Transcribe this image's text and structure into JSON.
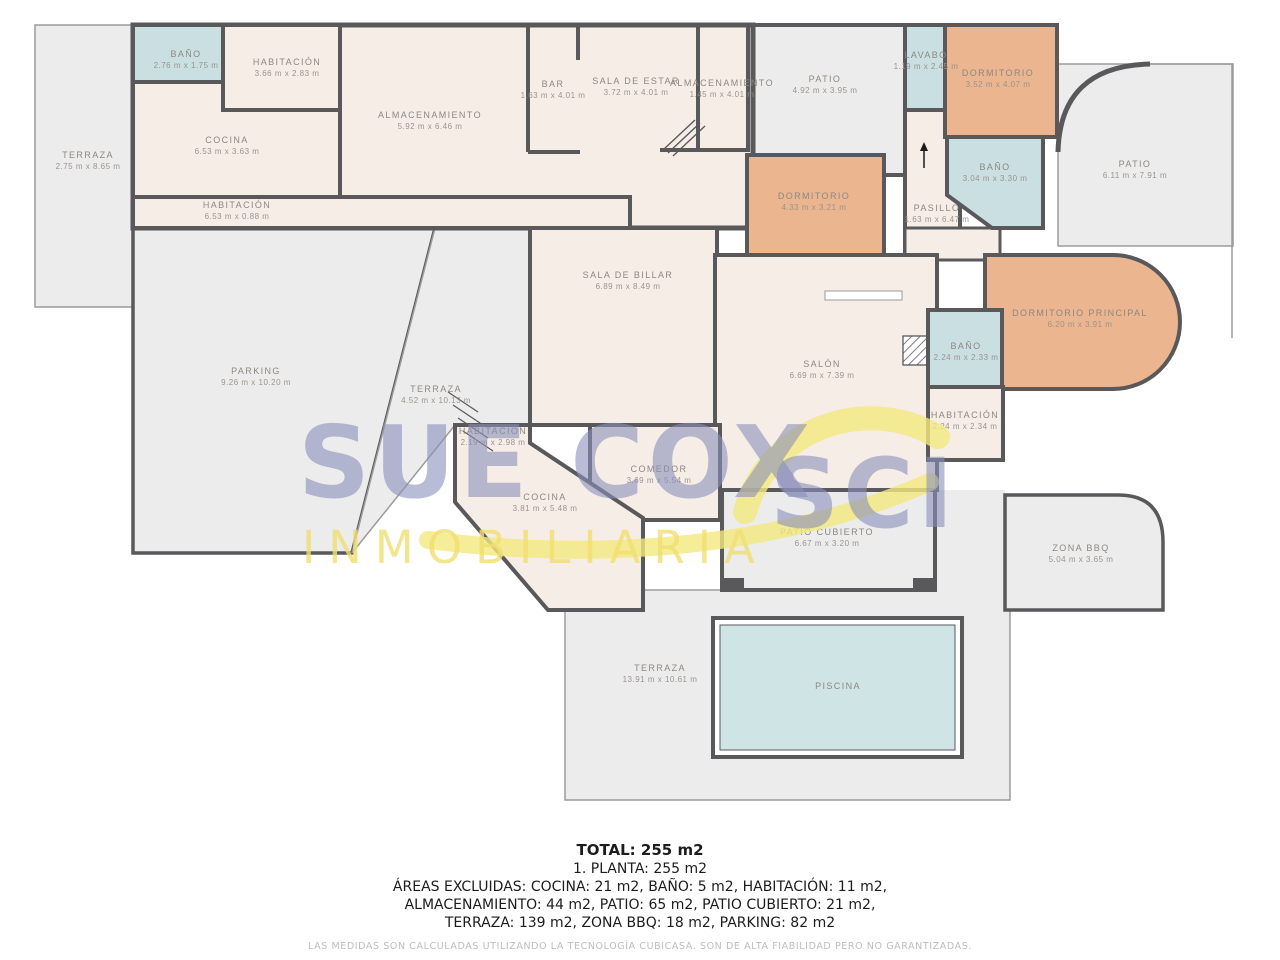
{
  "brand": {
    "name_part1": "SUE COX",
    "name_part2": "SCI",
    "tagline": "INMOBILIARIA"
  },
  "colors": {
    "wall": "#59595b",
    "interior": "#f6ede7",
    "excluded_area": "#ececec",
    "bedroom": "#eab58f",
    "bathroom": "#c9dfe2",
    "pool": "#cfe4e4",
    "label": "#8e8882",
    "watermark_blue": "#8a90ba",
    "watermark_yellow": "#f0df70"
  },
  "rooms": [
    {
      "name": "TERRAZA",
      "dims": "2.75 m x 8.65 m"
    },
    {
      "name": "BAÑO",
      "dims": "2.76 m x 1.75 m"
    },
    {
      "name": "HABITACIÓN",
      "dims": "3.66 m x 2.83 m"
    },
    {
      "name": "COCINA",
      "dims": "6.53 m x 3.63 m"
    },
    {
      "name": "ALMACENAMIENTO",
      "dims": "5.92 m x 6.46 m"
    },
    {
      "name": "HABITACIÓN",
      "dims": "6.53 m x 0.88 m"
    },
    {
      "name": "BAR",
      "dims": "1.63 m x 4.01 m"
    },
    {
      "name": "SALA DE ESTAR",
      "dims": "3.72 m x 4.01 m"
    },
    {
      "name": "ALMACENAMIENTO",
      "dims": "1.45 m x 4.01 m"
    },
    {
      "name": "PATIO",
      "dims": "4.92 m x 3.95 m"
    },
    {
      "name": "LAVABO",
      "dims": "1.19 m x 2.45 m"
    },
    {
      "name": "DORMITORIO",
      "dims": "3.52 m x 4.07 m"
    },
    {
      "name": "BAÑO",
      "dims": "3.04 m x 3.30 m"
    },
    {
      "name": "PASILLO",
      "dims": "1.63 m x 6.47 m"
    },
    {
      "name": "DORMITORIO",
      "dims": "4.33 m x 3.21 m"
    },
    {
      "name": "PATIO",
      "dims": "6.11 m x 7.91 m"
    },
    {
      "name": "SALA DE BILLAR",
      "dims": "6.89 m x 8.49 m"
    },
    {
      "name": "SALÓN",
      "dims": "6.69 m x 7.39 m"
    },
    {
      "name": "DORMITORIO PRINCIPAL",
      "dims": "6.20 m x 3.91 m"
    },
    {
      "name": "BAÑO",
      "dims": "2.24 m x 2.33 m"
    },
    {
      "name": "HABITACIÓN",
      "dims": "2.24 m x 2.34 m"
    },
    {
      "name": "PARKING",
      "dims": "9.26 m x 10.20 m"
    },
    {
      "name": "TERRAZA",
      "dims": "4.52 m x 10.13 m"
    },
    {
      "name": "HABITACIÓN",
      "dims": "2.19 m x 2.98 m"
    },
    {
      "name": "COCINA",
      "dims": "3.81 m x 5.48 m"
    },
    {
      "name": "COMEDOR",
      "dims": "3.69 m x 5.54 m"
    },
    {
      "name": "PATIO CUBIERTO",
      "dims": "6.67 m x 3.20 m"
    },
    {
      "name": "ZONA BBQ",
      "dims": "5.04 m x 3.65 m"
    },
    {
      "name": "TERRAZA",
      "dims": "13.91 m x 10.61 m"
    },
    {
      "name": "PISCINA",
      "dims": ""
    }
  ],
  "summary": {
    "total": "TOTAL: 255 m2",
    "floor": "1. PLANTA: 255 m2",
    "excluded_line1": "ÁREAS EXCLUIDAS: COCINA: 21 m2, BAÑO: 5 m2, HABITACIÓN: 11 m2,",
    "excluded_line2": "ALMACENAMIENTO: 44 m2, PATIO: 65 m2, PATIO CUBIERTO: 21 m2,",
    "excluded_line3": "TERRAZA: 139 m2, ZONA BBQ: 18 m2, PARKING: 82 m2",
    "disclaimer": "LAS MEDIDAS SON CALCULADAS UTILIZANDO LA TECNOLOGÍA CUBICASA. SON DE ALTA FIABILIDAD PERO NO GARANTIZADAS."
  }
}
